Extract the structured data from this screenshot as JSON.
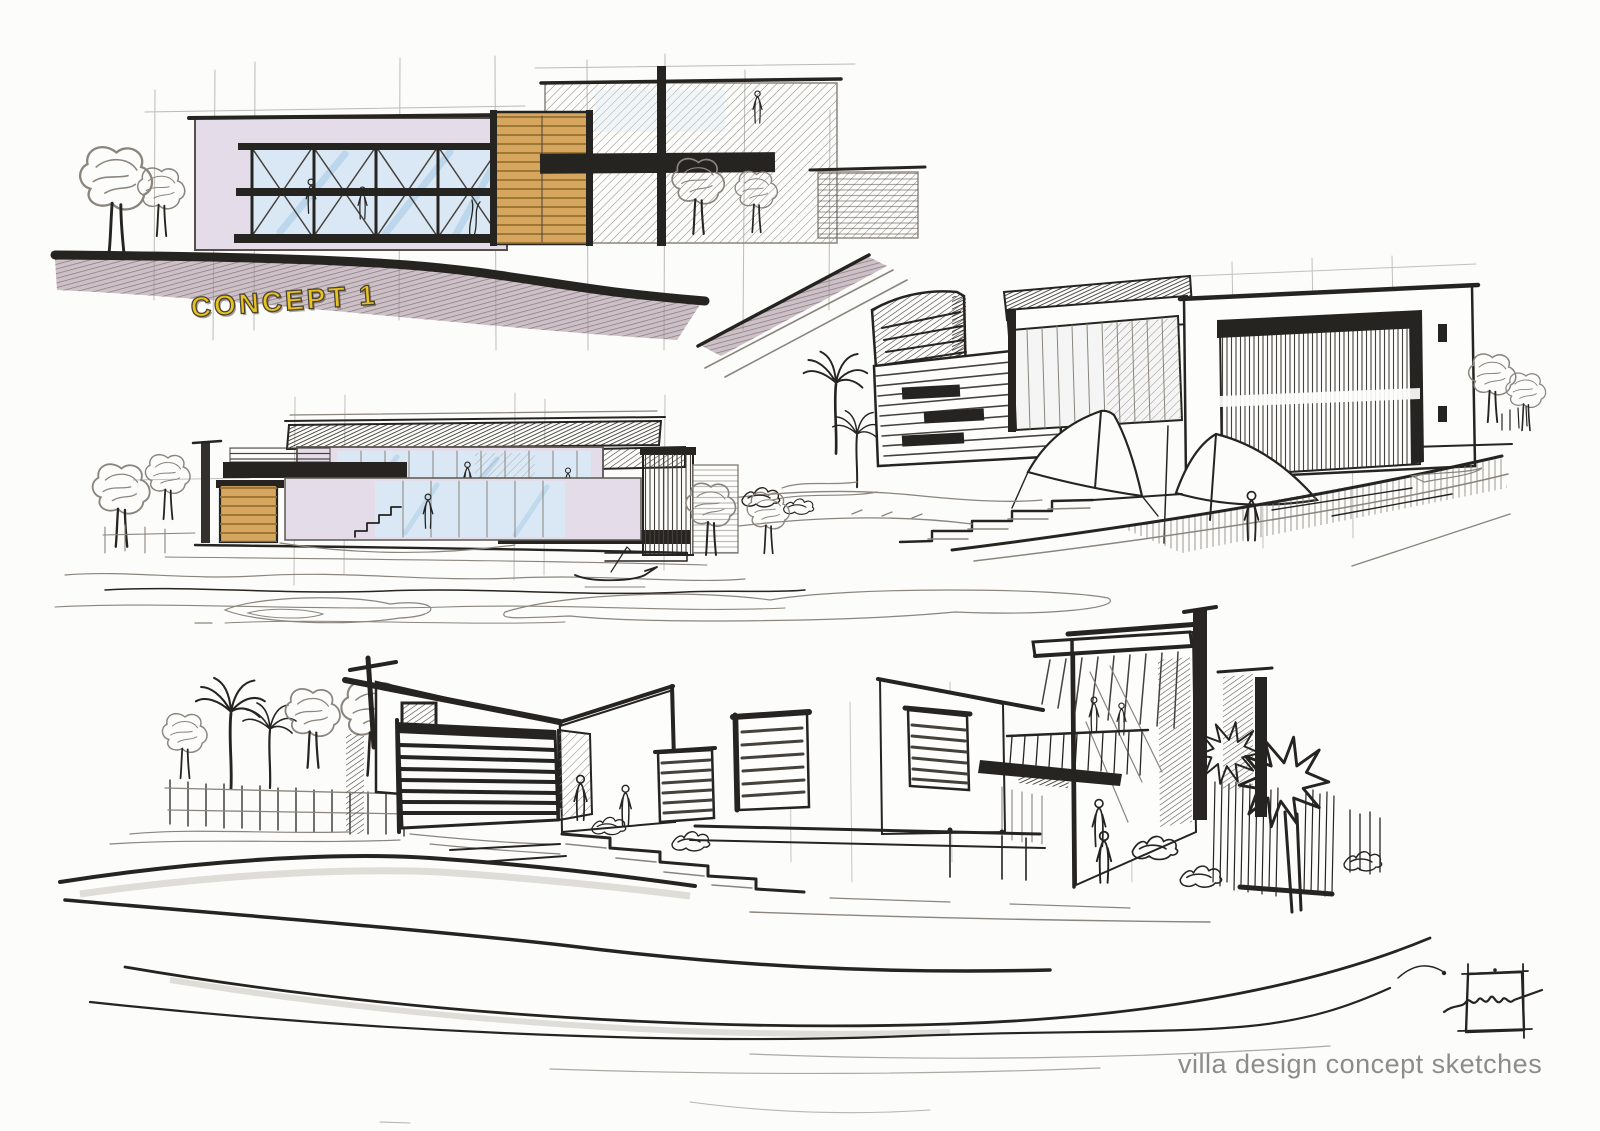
{
  "sheet": {
    "background": "#fcfcfa",
    "caption": "villa design concept sketches"
  },
  "labels": {
    "concept1": "CONCEPT 1"
  },
  "sketches": [
    {
      "name": "concept-1-elevation",
      "media": "ink with lavender, blue and wood marker"
    },
    {
      "name": "perspective-with-canopies",
      "media": "ink"
    },
    {
      "name": "waterfront-elevation",
      "media": "ink with lavender, blue and wood marker"
    },
    {
      "name": "large-perspective",
      "media": "ink"
    }
  ],
  "colors": {
    "ink": "#262420",
    "pencil": "#8a857d",
    "wall_lavender": "#e5dcea",
    "glass_blue": "#d9e8f4",
    "glass_streak": "#a9c9e4",
    "wood_tan": "#d6a55e",
    "wood_shadow": "#97702f",
    "ground_mauve": "#8e7983",
    "label_yellow": "#e9c41f",
    "label_outline": "#4a4334",
    "caption_gray": "#8c8c8c",
    "sheet_bg": "#fcfcfa"
  }
}
